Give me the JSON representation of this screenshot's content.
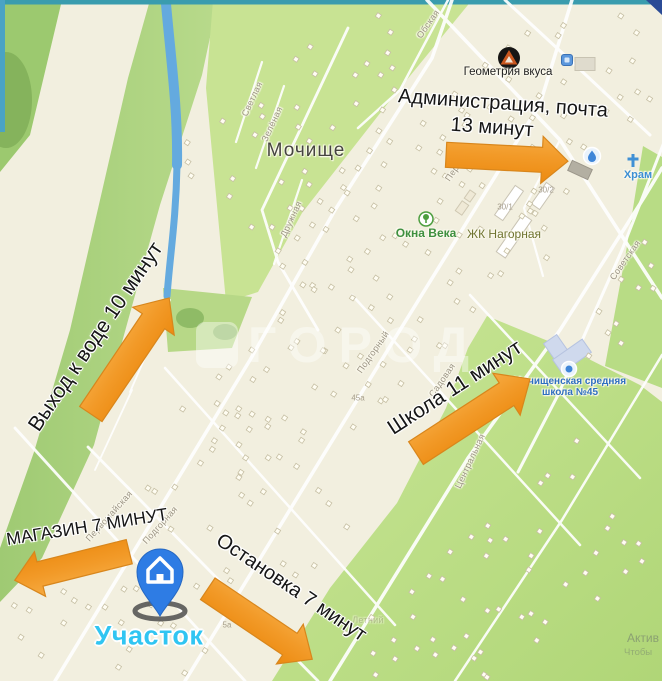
{
  "map": {
    "town_label": "Мочище",
    "street_labels": [
      {
        "text": "Обская",
        "x": 428,
        "y": 24,
        "rot": -55
      },
      {
        "text": "Светлая",
        "x": 252,
        "y": 99,
        "rot": -65
      },
      {
        "text": "Зелёная",
        "x": 272,
        "y": 124,
        "rot": -65
      },
      {
        "text": "Дружная",
        "x": 291,
        "y": 219,
        "rot": -65
      },
      {
        "text": "Пер",
        "x": 452,
        "y": 173,
        "rot": -55
      },
      {
        "text": "Подгорный",
        "x": 373,
        "y": 352,
        "rot": -55
      },
      {
        "text": "Садовая",
        "x": 442,
        "y": 380,
        "rot": -55
      },
      {
        "text": "Советская",
        "x": 625,
        "y": 260,
        "rot": -55
      },
      {
        "text": "Центральная",
        "x": 470,
        "y": 461,
        "rot": -65
      },
      {
        "text": "Первомайская",
        "x": 109,
        "y": 516,
        "rot": -48
      },
      {
        "text": "Подгорная",
        "x": 160,
        "y": 525,
        "rot": -48
      },
      {
        "text": "Летний",
        "x": 368,
        "y": 620,
        "rot": 0,
        "faint": true
      }
    ],
    "building_numbers": [
      {
        "text": "30/1",
        "x": 505,
        "y": 207
      },
      {
        "text": "30/2",
        "x": 546,
        "y": 190
      },
      {
        "text": "45а",
        "x": 358,
        "y": 398
      },
      {
        "text": "5а",
        "x": 227,
        "y": 625
      }
    ],
    "poi": {
      "geometry_vkusa": "Геометрия вкуса",
      "okna_veka": "Окна Века",
      "zhk_nagornaya": "ЖК Нагорная",
      "school_line1": "Мочищенская средняя",
      "school_line2": "школа №45",
      "khram": "Храм"
    },
    "watermark": "ГОРОД",
    "activation": {
      "line1": "Актив",
      "line2": "Чтобы"
    }
  },
  "annotations": {
    "admin": {
      "line1": "Администрация, почта",
      "line2": "13 минут"
    },
    "water": {
      "label": "Выход к воде 10 минут"
    },
    "school": {
      "label": "Школа 11 минут"
    },
    "shop": {
      "label": "МАГАЗИН 7 МИНУТ"
    },
    "bus": {
      "label": "Остановка 7 минут"
    },
    "plot": {
      "label": "Участок"
    }
  },
  "colors": {
    "arrow_top": "#f6ab42",
    "arrow_mid": "#f29a28",
    "arrow_bottom": "#ec8a10",
    "arrow_stroke": "#d8861c",
    "pin_blue": "#2e7ce4",
    "pin_edge": "#2668c2",
    "plot_label": "#30c5f2",
    "water": "#64aadf",
    "map_bg": "#f2efdf",
    "green_light": "#c8e393",
    "green_mid": "#aed381",
    "road": "#ffffff",
    "edge_teal": "#3a9cae",
    "poi_blue": "#2e6fc0",
    "poi_green": "#3e8f3f"
  }
}
